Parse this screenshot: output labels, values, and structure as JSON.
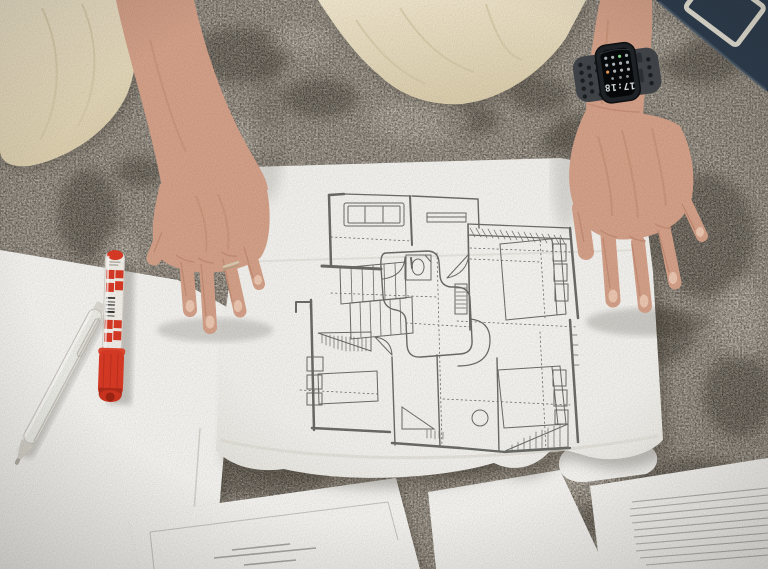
{
  "meta": {
    "type": "photograph",
    "description": "Overhead photo of a person kneeling on a patterned grey carpet, both hands spread to hold down a printed architectural floor plan; a red marker, a white pen and printed document sheets lie around it, a smartwatch on the right wrist shows 17:18, a dark folder sits at the top-right corner"
  },
  "watch": {
    "label": "smartwatch",
    "time": "17:18"
  },
  "objects": {
    "blueprint": "architectural floor-plan print",
    "marker": "red marker with cap",
    "pen": "white click pen",
    "documents": "printed document sheets",
    "carpet": "patterned grey carpet",
    "fabric": "beige garment of kneeling person",
    "left_hand": "left hand with ring",
    "right_hand": "right hand with smartwatch",
    "folder": "dark navy folder at top right"
  },
  "colors": {
    "carpet_base": "#a89e90",
    "carpet_dark": "#453e33",
    "carpet_light": "#d3cabb",
    "fabric": "#eadfc6",
    "skin": "#d5a189",
    "skin_shadow": "#b97f66",
    "paper": "#f4f3f0",
    "plan_line": "#6b6b68",
    "marker_red": "#da3b26",
    "marker_red_dark": "#b02c1a",
    "watch_band": "#42464a",
    "watch_case": "#202327",
    "screen": "#07090b",
    "screen_text": "#dce2e5",
    "folder_navy": "#2c3c4e"
  }
}
